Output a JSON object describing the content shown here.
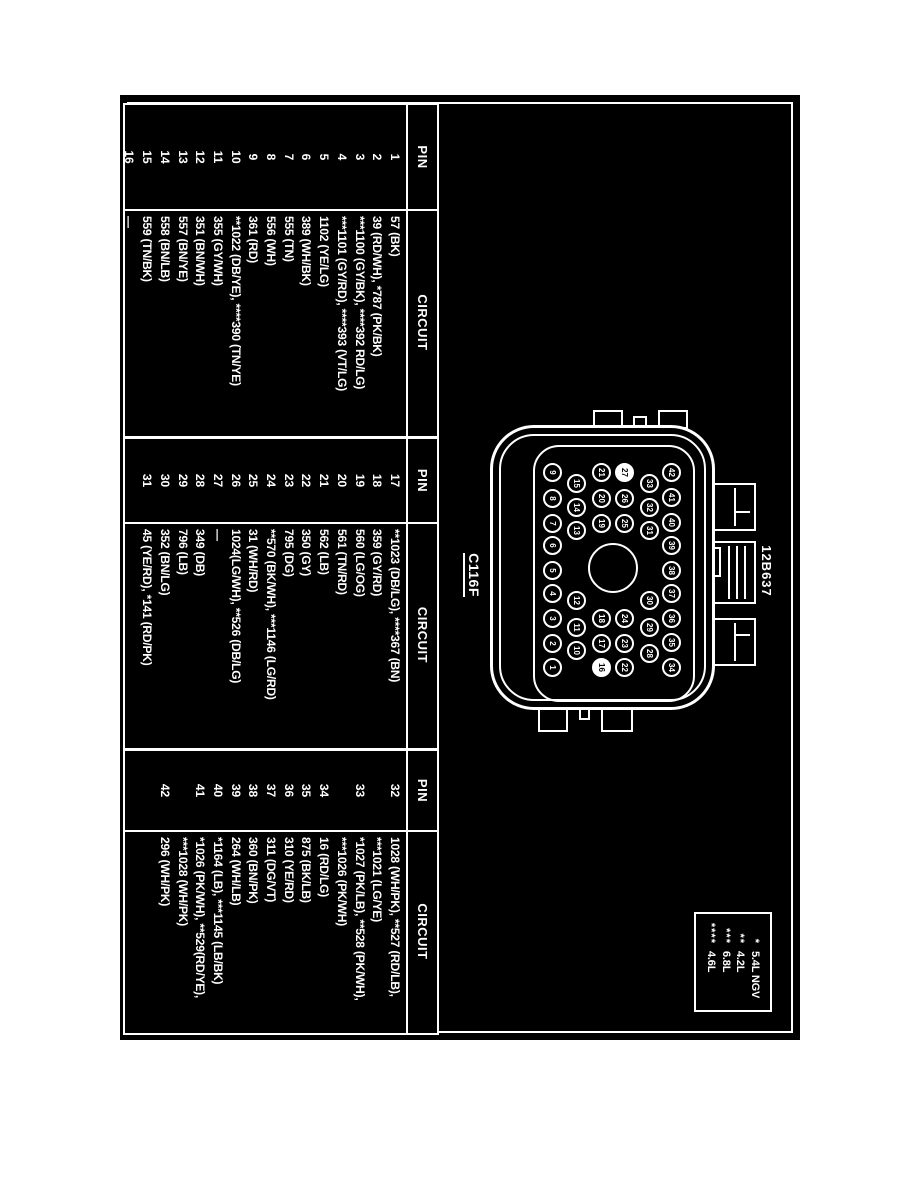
{
  "colors": {
    "page_bg": "#ffffff",
    "diagram_bg": "#000000",
    "line": "#ffffff"
  },
  "labels": {
    "part_number": "12B637",
    "connector_name": "C116F"
  },
  "legend": {
    "items": [
      {
        "symbol": "*",
        "label": "5.4L NGV"
      },
      {
        "symbol": "**",
        "label": "4.2L"
      },
      {
        "symbol": "***",
        "label": "6.8L"
      },
      {
        "symbol": "****",
        "label": "4.6L"
      }
    ]
  },
  "tables": [
    {
      "headers": {
        "pin": "PIN",
        "circuit": "CIRCUIT"
      },
      "rows": [
        {
          "pin": "1",
          "circuit": "57 (BK)"
        },
        {
          "pin": "2",
          "circuit": "39 (RD/WH), *787 (PK/BK)"
        },
        {
          "pin": "3",
          "circuit": "***1100 (GY/BK), ****392 RD/LG)"
        },
        {
          "pin": "4",
          "circuit": "***1101 (GY/RD), ****393 (VT/LG)"
        },
        {
          "pin": "5",
          "circuit": "1102 (YE/LG)"
        },
        {
          "pin": "6",
          "circuit": "389 (WH/BK)"
        },
        {
          "pin": "7",
          "circuit": "555 (TN)"
        },
        {
          "pin": "8",
          "circuit": "556 (WH)"
        },
        {
          "pin": "9",
          "circuit": "361 (RD)"
        },
        {
          "pin": "10",
          "circuit": "**1022 (DB/YE), ****390 (TN/YE)"
        },
        {
          "pin": "11",
          "circuit": "355 (GY/WH)"
        },
        {
          "pin": "12",
          "circuit": "351 (BN/WH)"
        },
        {
          "pin": "13",
          "circuit": "557 (BN/YE)"
        },
        {
          "pin": "14",
          "circuit": "558 (BN/LB)"
        },
        {
          "pin": "15",
          "circuit": "559 (TN/BK)"
        },
        {
          "pin": "16",
          "circuit": "—"
        }
      ]
    },
    {
      "headers": {
        "pin": "PIN",
        "circuit": "CIRCUIT"
      },
      "rows": [
        {
          "pin": "17",
          "circuit": "**1023 (DB/LG), ****367 (BN)"
        },
        {
          "pin": "18",
          "circuit": "359 (GY/RD)"
        },
        {
          "pin": "19",
          "circuit": "560 (LG/OG)"
        },
        {
          "pin": "20",
          "circuit": "561 (TN/RD)"
        },
        {
          "pin": "21",
          "circuit": "562 (LB)"
        },
        {
          "pin": "22",
          "circuit": "350 (GY)"
        },
        {
          "pin": "23",
          "circuit": "795 (DG)"
        },
        {
          "pin": "24",
          "circuit": "**570 (BK/WH), ***1146 (LG/RD)"
        },
        {
          "pin": "25",
          "circuit": "31 (WH/RD)"
        },
        {
          "pin": "26",
          "circuit": "1024(LG/WH), **526 (DB/LG)"
        },
        {
          "pin": "27",
          "circuit": "—"
        },
        {
          "pin": "28",
          "circuit": "349 (DB)"
        },
        {
          "pin": "29",
          "circuit": "796 (LB)"
        },
        {
          "pin": "30",
          "circuit": "352 (BN/LG)"
        },
        {
          "pin": "31",
          "circuit": "45 (YE/RD), *141 (RD/PK)"
        }
      ]
    },
    {
      "headers": {
        "pin": "PIN",
        "circuit": "CIRCUIT"
      },
      "rows": [
        {
          "pin": "32",
          "circuit": "1028 (WH/PK), **527 (RD/LB),\n***1021 (LG/YE)"
        },
        {
          "pin": "33",
          "circuit": "*1027 (PK/LB), **528 (PK/WH),\n***1026 (PK/WH)"
        },
        {
          "pin": "34",
          "circuit": "16 (RD/LG)"
        },
        {
          "pin": "35",
          "circuit": "875 (BK/LB)"
        },
        {
          "pin": "36",
          "circuit": "310 (YE/RD)"
        },
        {
          "pin": "37",
          "circuit": "311 (DG/VT)"
        },
        {
          "pin": "38",
          "circuit": "360 (BN/PK)"
        },
        {
          "pin": "39",
          "circuit": "264 (WH/LB)"
        },
        {
          "pin": "40",
          "circuit": "*1164 (LB), ***1145 (LB/BK)"
        },
        {
          "pin": "41",
          "circuit": "*1026 (PK/WH), **529(RD/YE),\n***1028 (WH/PK)"
        },
        {
          "pin": "42",
          "circuit": "296 (WH/PK)"
        }
      ]
    }
  ],
  "connector": {
    "pin_count": 42,
    "no_circuit_pins": [
      16,
      27
    ],
    "pins": [
      {
        "n": 42,
        "x": 47,
        "y": 43,
        "filled": false
      },
      {
        "n": 41,
        "x": 72,
        "y": 43,
        "filled": false
      },
      {
        "n": 40,
        "x": 97,
        "y": 43,
        "filled": false
      },
      {
        "n": 39,
        "x": 120,
        "y": 43,
        "filled": false
      },
      {
        "n": 38,
        "x": 145,
        "y": 43,
        "filled": false
      },
      {
        "n": 37,
        "x": 168,
        "y": 43,
        "filled": false
      },
      {
        "n": 36,
        "x": 193,
        "y": 43,
        "filled": false
      },
      {
        "n": 35,
        "x": 217,
        "y": 43,
        "filled": false
      },
      {
        "n": 34,
        "x": 242,
        "y": 43,
        "filled": false
      },
      {
        "n": 33,
        "x": 58,
        "y": 65,
        "filled": false
      },
      {
        "n": 32,
        "x": 82,
        "y": 65,
        "filled": false
      },
      {
        "n": 31,
        "x": 105,
        "y": 65,
        "filled": false
      },
      {
        "n": 30,
        "x": 175,
        "y": 65,
        "filled": false
      },
      {
        "n": 29,
        "x": 202,
        "y": 65,
        "filled": false
      },
      {
        "n": 28,
        "x": 228,
        "y": 65,
        "filled": false
      },
      {
        "n": 27,
        "x": 47,
        "y": 90,
        "filled": true
      },
      {
        "n": 26,
        "x": 73,
        "y": 90,
        "filled": false
      },
      {
        "n": 25,
        "x": 98,
        "y": 90,
        "filled": false
      },
      {
        "n": 24,
        "x": 193,
        "y": 90,
        "filled": false
      },
      {
        "n": 23,
        "x": 218,
        "y": 90,
        "filled": false
      },
      {
        "n": 22,
        "x": 242,
        "y": 90,
        "filled": false
      },
      {
        "n": 21,
        "x": 47,
        "y": 113,
        "filled": false
      },
      {
        "n": 20,
        "x": 73,
        "y": 113,
        "filled": false
      },
      {
        "n": 19,
        "x": 98,
        "y": 113,
        "filled": false
      },
      {
        "n": 18,
        "x": 193,
        "y": 113,
        "filled": false
      },
      {
        "n": 17,
        "x": 218,
        "y": 113,
        "filled": false
      },
      {
        "n": 16,
        "x": 242,
        "y": 113,
        "filled": true
      },
      {
        "n": 15,
        "x": 58,
        "y": 138,
        "filled": false
      },
      {
        "n": 14,
        "x": 82,
        "y": 138,
        "filled": false
      },
      {
        "n": 13,
        "x": 105,
        "y": 138,
        "filled": false
      },
      {
        "n": 12,
        "x": 175,
        "y": 138,
        "filled": false
      },
      {
        "n": 11,
        "x": 202,
        "y": 138,
        "filled": false
      },
      {
        "n": 10,
        "x": 225,
        "y": 138,
        "filled": false
      },
      {
        "n": 9,
        "x": 47,
        "y": 162,
        "filled": false
      },
      {
        "n": 8,
        "x": 73,
        "y": 162,
        "filled": false
      },
      {
        "n": 7,
        "x": 98,
        "y": 162,
        "filled": false
      },
      {
        "n": 6,
        "x": 120,
        "y": 162,
        "filled": false
      },
      {
        "n": 5,
        "x": 145,
        "y": 162,
        "filled": false
      },
      {
        "n": 4,
        "x": 168,
        "y": 162,
        "filled": false
      },
      {
        "n": 3,
        "x": 193,
        "y": 162,
        "filled": false
      },
      {
        "n": 2,
        "x": 218,
        "y": 162,
        "filled": false
      },
      {
        "n": 1,
        "x": 242,
        "y": 162,
        "filled": false
      }
    ]
  }
}
